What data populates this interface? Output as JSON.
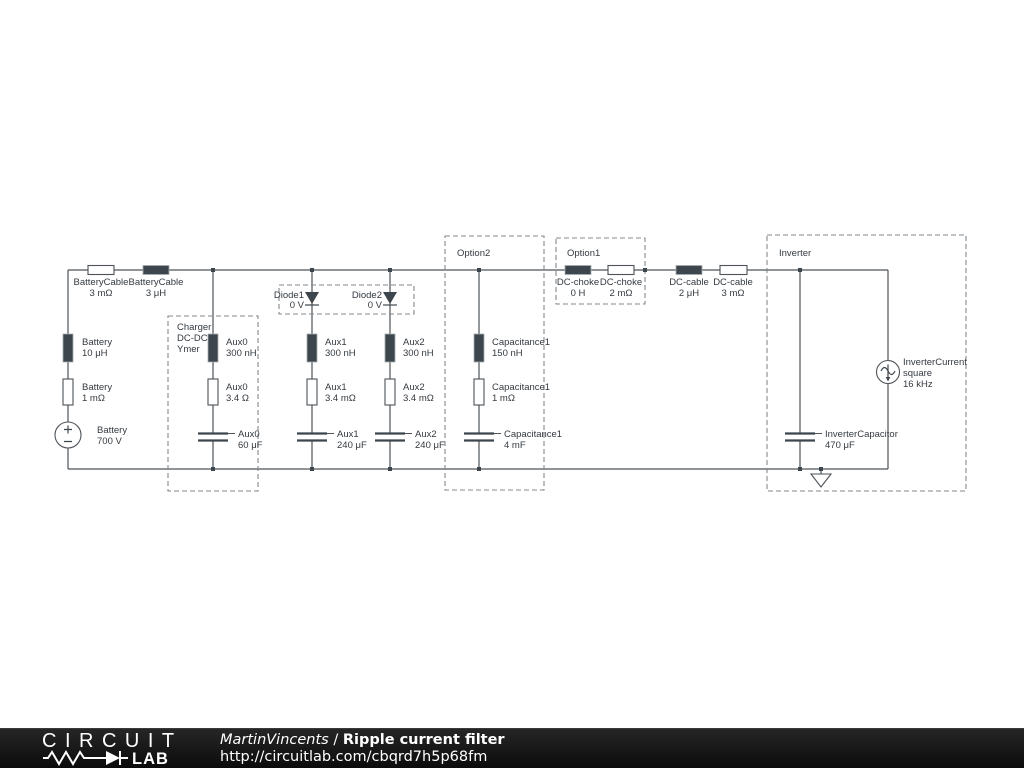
{
  "colors": {
    "canvas": "#ffffff",
    "wire": "#4d5358",
    "component_dark": "#3e464d",
    "component_light": "#ffffff",
    "dashed_box": "#82888c",
    "label_text": "#343a40",
    "footer_bg": "#151515",
    "footer_text": "#ffffff"
  },
  "groups": {
    "charger": {
      "line1": "Charger",
      "line2": "DC-DC",
      "line3": "Ymer"
    },
    "option2": {
      "label": "Option2"
    },
    "option1": {
      "label": "Option1"
    },
    "inverter": {
      "label": "Inverter"
    }
  },
  "components": {
    "battery_cable_r": {
      "name": "BatteryCable",
      "value": "3 mΩ"
    },
    "battery_cable_l": {
      "name": "BatteryCable",
      "value": "3 μH"
    },
    "battery_l": {
      "name": "Battery",
      "value": "10 μH"
    },
    "battery_r": {
      "name": "Battery",
      "value": "1 mΩ"
    },
    "battery_v": {
      "name": "Battery",
      "value": "700 V"
    },
    "aux0_l": {
      "name": "Aux0",
      "value": "300 nH"
    },
    "aux0_r": {
      "name": "Aux0",
      "value": "3.4 Ω"
    },
    "aux0_c": {
      "name": "Aux0",
      "value": "60 μF"
    },
    "diode1": {
      "name": "Diode1",
      "value": "0 V"
    },
    "diode2": {
      "name": "Diode2",
      "value": "0 V"
    },
    "aux1_l": {
      "name": "Aux1",
      "value": "300 nH"
    },
    "aux1_r": {
      "name": "Aux1",
      "value": "3.4 mΩ"
    },
    "aux1_c": {
      "name": "Aux1",
      "value": "240 μF"
    },
    "aux2_l": {
      "name": "Aux2",
      "value": "300 nH"
    },
    "aux2_r": {
      "name": "Aux2",
      "value": "3.4 mΩ"
    },
    "aux2_c": {
      "name": "Aux2",
      "value": "240 μF"
    },
    "cap1_l": {
      "name": "Capacitance1",
      "value": "150 nH"
    },
    "cap1_r": {
      "name": "Capacitance1",
      "value": "1 mΩ"
    },
    "cap1_c": {
      "name": "Capacitance1",
      "value": "4 mF"
    },
    "dc_choke_l": {
      "name": "DC-choke",
      "value": "0 H"
    },
    "dc_choke_r": {
      "name": "DC-choke",
      "value": "2 mΩ"
    },
    "dc_cable_l": {
      "name": "DC-cable",
      "value": "2 μH"
    },
    "dc_cable_r": {
      "name": "DC-cable",
      "value": "3 mΩ"
    },
    "inverter_cap": {
      "name": "InverterCapacitor",
      "value": "470 μF"
    },
    "inverter_cur": {
      "name": "InverterCurrent",
      "mode": "square",
      "value": "16 kHz"
    }
  },
  "footer": {
    "logo_top": "CIRCUIT",
    "logo_bottom": "LAB",
    "author": "MartinVincents",
    "separator": " / ",
    "title": "Ripple current filter",
    "url": "http://circuitlab.com/cbqrd7h5p68fm"
  }
}
